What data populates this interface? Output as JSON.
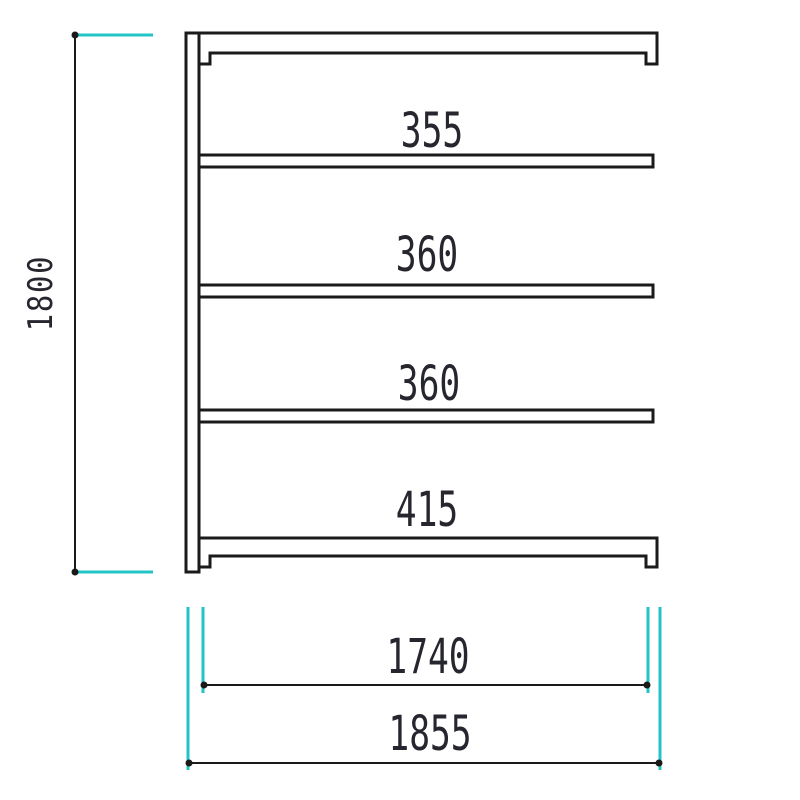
{
  "drawing": {
    "type": "shelf-unit-front-elevation",
    "labels": {
      "overall_height": "1800",
      "opening_top": "355",
      "opening_second": "360",
      "opening_third": "360",
      "opening_bottom": "415",
      "width_inner": "1740",
      "width_overall": "1855"
    },
    "dimensions_mm": {
      "overall_height": 1800,
      "shelf_openings_top_to_bottom": [
        355,
        360,
        360,
        415
      ],
      "inner_width": 1740,
      "overall_width": 1855
    },
    "colors": {
      "line": "#1a1a1a",
      "extension": "#22c4c6",
      "text": "#26262e",
      "background": "#ffffff"
    }
  }
}
